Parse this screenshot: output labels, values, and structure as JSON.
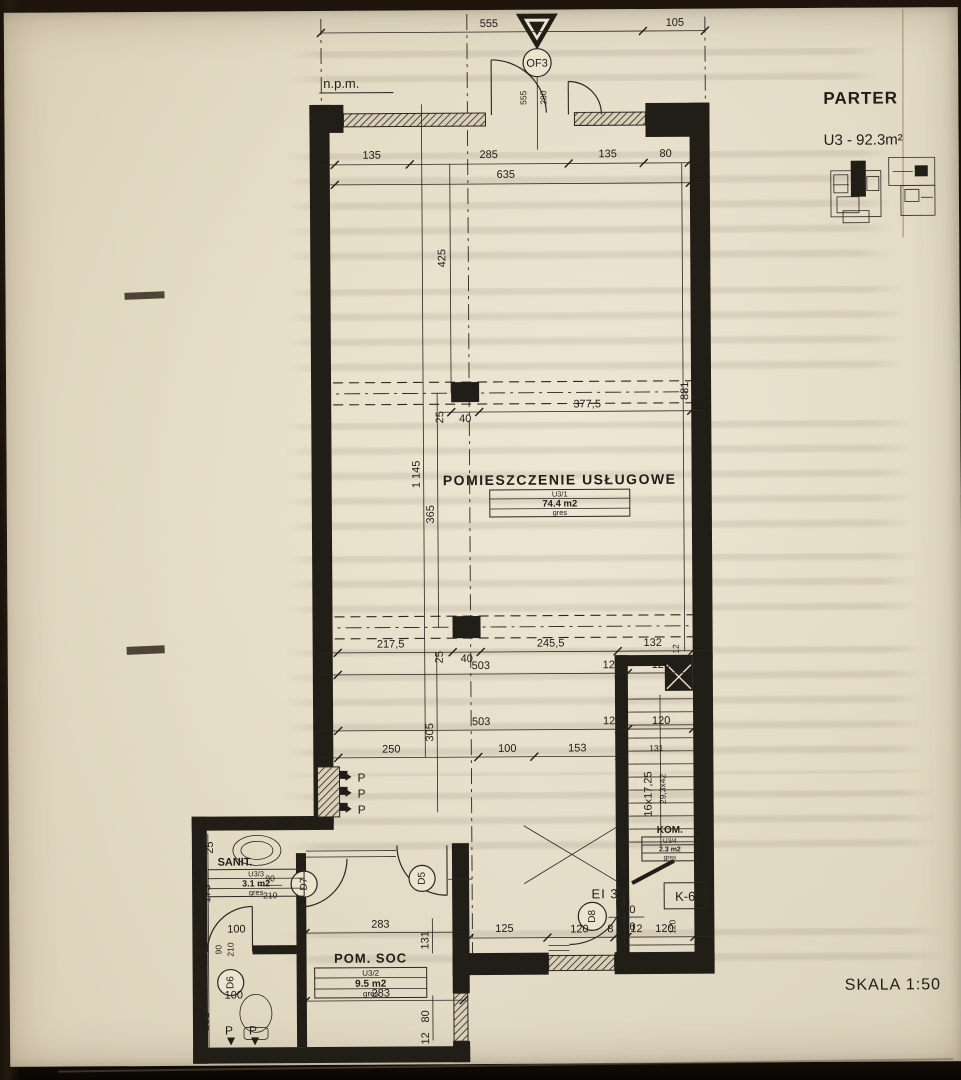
{
  "sheet": {
    "title": "PARTER",
    "unit": "U3 - 92.3m²",
    "scale": "SKALA 1:50",
    "datum": "n.p.m.",
    "entry_marker": "OF3"
  },
  "rooms": {
    "main": {
      "name": "POMIESZCZENIE USŁUGOWE",
      "no": "U3/1",
      "area": "74.4 m2",
      "finish": "gres"
    },
    "social": {
      "name": "POM. SOC",
      "no": "U3/2",
      "area": "9.5 m2",
      "finish": "gres"
    },
    "sanitary": {
      "name": "SANIT.",
      "no": "U3/3",
      "area": "3.1 m2",
      "finish": "gres"
    },
    "closet": {
      "name": "KOM.",
      "no": "U3/4",
      "area": "2.3 m2",
      "finish": "gres"
    }
  },
  "doors": {
    "d5": {
      "label": "D5",
      "w": "100",
      "h": "210"
    },
    "d6": {
      "label": "D6",
      "w": "90",
      "h": "210"
    },
    "d7": {
      "label": "D7",
      "w": "90",
      "h": "210"
    },
    "d8": {
      "label": "D8",
      "w": "100",
      "h": "210",
      "fire": "EI 30"
    },
    "k6": "K-6"
  },
  "stairs": {
    "note1": "16x17,25",
    "note2": "29,3x42",
    "flight": "131",
    "top": "132",
    "side12": "12",
    "v120": "120"
  },
  "riser_label": "P",
  "dims": {
    "top": [
      "555",
      "105"
    ],
    "entry": [
      "555",
      "280"
    ],
    "row1": [
      "135",
      "285",
      "135",
      "80",
      "25"
    ],
    "row2": [
      "635",
      "25"
    ],
    "col1": [
      "25",
      "40",
      "377,5",
      "25"
    ],
    "rowA": [
      "217,5",
      "25",
      "40",
      "245,5",
      "132"
    ],
    "rowB": [
      "503",
      "12",
      "120"
    ],
    "rowC": [
      "503",
      "12",
      "120"
    ],
    "rowD": [
      "250",
      "100",
      "153"
    ],
    "bottom": [
      "120",
      "8",
      "12",
      "120"
    ],
    "v425": "425",
    "v881": "881",
    "v1145": "1 145",
    "v365": "365",
    "v305": "305",
    "soc283a": "283",
    "soc283b": "283",
    "soc125": "125",
    "soc131": "131",
    "soc80": "80",
    "soc12": "12",
    "san25": "25",
    "san173": "173",
    "san12": "12",
    "san100a": "100",
    "san100b": "100",
    "san201": "201"
  }
}
